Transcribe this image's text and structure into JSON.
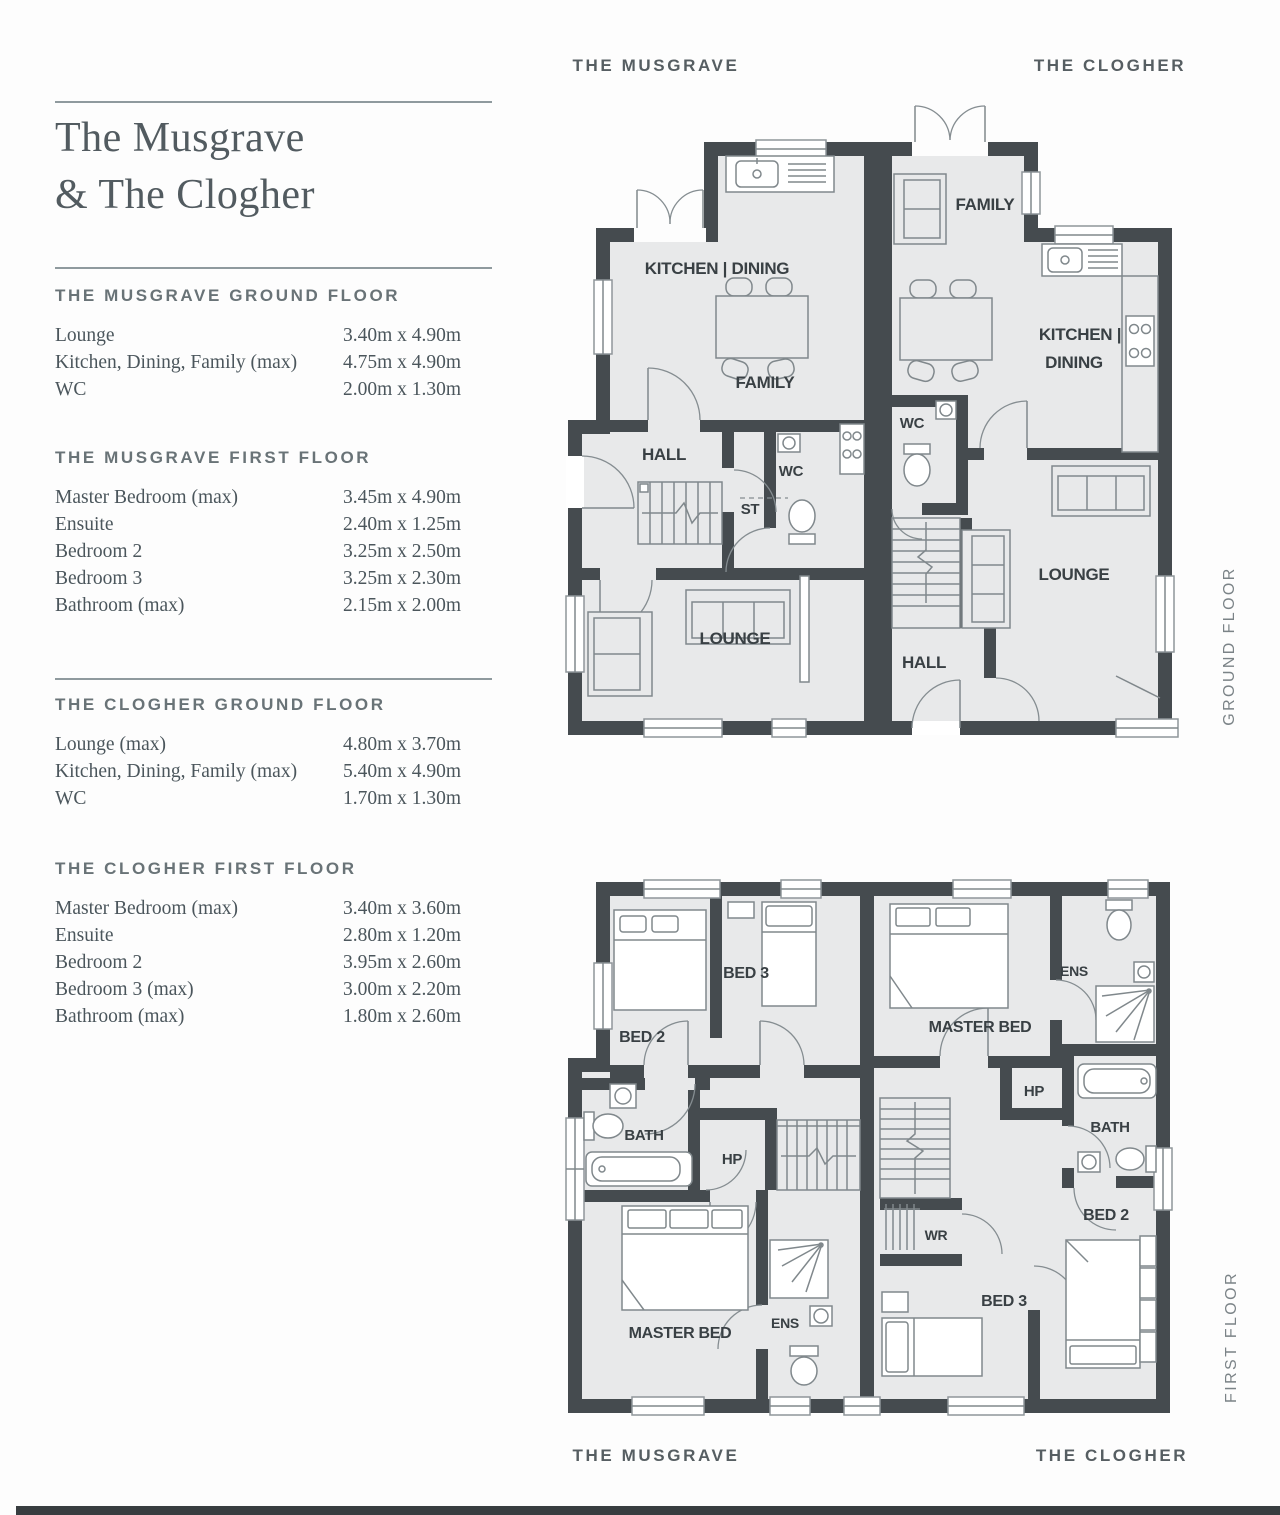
{
  "header": {
    "musgrave": "THE MUSGRAVE",
    "clogher": "THE CLOGHER"
  },
  "footer": {
    "musgrave": "THE MUSGRAVE",
    "clogher": "THE CLOGHER"
  },
  "side": {
    "ground": "GROUND FLOOR",
    "first": "FIRST FLOOR"
  },
  "sidebar": {
    "title_line1": "The Musgrave",
    "title_line2": "& The Clogher",
    "sections": [
      {
        "heading": "THE MUSGRAVE GROUND FLOOR",
        "rows": [
          {
            "label": "Lounge",
            "dim": "3.40m x 4.90m"
          },
          {
            "label": "Kitchen, Dining, Family (max)",
            "dim": "4.75m x 4.90m"
          },
          {
            "label": "WC",
            "dim": "2.00m x 1.30m"
          }
        ]
      },
      {
        "heading": "THE MUSGRAVE FIRST FLOOR",
        "rows": [
          {
            "label": "Master Bedroom (max)",
            "dim": "3.45m x 4.90m"
          },
          {
            "label": "Ensuite",
            "dim": "2.40m x 1.25m"
          },
          {
            "label": "Bedroom 2",
            "dim": "3.25m x 2.50m"
          },
          {
            "label": "Bedroom 3",
            "dim": "3.25m x 2.30m"
          },
          {
            "label": "Bathroom (max)",
            "dim": "2.15m x 2.00m"
          }
        ]
      },
      {
        "heading": "THE CLOGHER GROUND FLOOR",
        "rows": [
          {
            "label": "Lounge (max)",
            "dim": "4.80m x 3.70m"
          },
          {
            "label": "Kitchen, Dining, Family (max)",
            "dim": "5.40m x 4.90m"
          },
          {
            "label": "WC",
            "dim": "1.70m x 1.30m"
          }
        ]
      },
      {
        "heading": "THE CLOGHER FIRST FLOOR",
        "rows": [
          {
            "label": "Master Bedroom (max)",
            "dim": "3.40m x 3.60m"
          },
          {
            "label": "Ensuite",
            "dim": "2.80m x 1.20m"
          },
          {
            "label": "Bedroom 2",
            "dim": "3.95m x 2.60m"
          },
          {
            "label": "Bedroom 3 (max)",
            "dim": "3.00m x 2.20m"
          },
          {
            "label": "Bathroom (max)",
            "dim": "1.80m x 2.60m"
          }
        ]
      }
    ]
  },
  "ground_plan": {
    "musgrave": {
      "kitchen_dining": "KITCHEN | DINING",
      "family": "FAMILY",
      "hall": "HALL",
      "st": "ST",
      "wc": "WC",
      "lounge": "LOUNGE"
    },
    "clogher": {
      "family": "FAMILY",
      "kitchen_line1": "KITCHEN |",
      "kitchen_line2": "DINING",
      "wc": "WC",
      "lounge": "LOUNGE",
      "hall": "HALL"
    }
  },
  "first_plan": {
    "musgrave": {
      "bed2": "BED 2",
      "bed3": "BED 3",
      "bath": "BATH",
      "hp": "HP",
      "master": "MASTER BED",
      "ens": "ENS"
    },
    "clogher": {
      "master": "MASTER BED",
      "ens": "ENS",
      "hp": "HP",
      "bath": "BATH",
      "wr": "WR",
      "bed3": "BED 3",
      "bed2": "BED 2"
    }
  },
  "colors": {
    "wall": "#454b4f",
    "room_fill": "#e8e9ea",
    "label_text": "#394044",
    "muted_text": "#7b8387",
    "bottom_bar": "#383d40"
  }
}
